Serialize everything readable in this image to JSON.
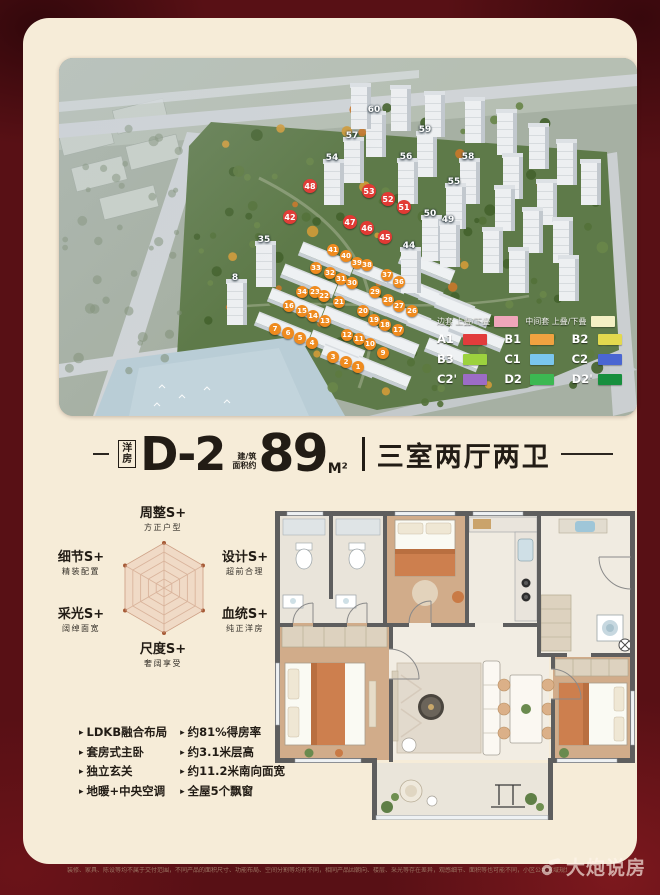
{
  "frame": {
    "maroon": "#581015",
    "cream": "#f6ecd8"
  },
  "aerial": {
    "legend": {
      "header": [
        {
          "label": "边套",
          "sub": "上叠/下叠",
          "color": "#f0a6ba"
        },
        {
          "label": "中间套",
          "sub": "上叠/下叠",
          "color": "#f4f0c4"
        }
      ],
      "rows": [
        [
          {
            "code": "A1",
            "color": "#e23c3c"
          },
          {
            "code": "B1",
            "color": "#f0a240"
          },
          {
            "code": "B2",
            "color": "#e3d94e"
          }
        ],
        [
          {
            "code": "B3",
            "color": "#9cd23e"
          },
          {
            "code": "C1",
            "color": "#7ac6ee"
          },
          {
            "code": "C2",
            "color": "#4a66d2"
          }
        ],
        [
          {
            "code": "C2'",
            "color": "#9c6cc6"
          },
          {
            "code": "D2",
            "color": "#3cb852"
          },
          {
            "code": "D2'",
            "color": "#178f3e"
          }
        ]
      ]
    },
    "marker_colors": {
      "red": "#e13a34",
      "orange": "#ef8b1f",
      "tower_text": "#ffffff"
    },
    "tower_labels": [
      {
        "n": "60",
        "x": 315,
        "y": 52
      },
      {
        "n": "57",
        "x": 293,
        "y": 78
      },
      {
        "n": "59",
        "x": 366,
        "y": 72
      },
      {
        "n": "54",
        "x": 273,
        "y": 100
      },
      {
        "n": "56",
        "x": 347,
        "y": 99
      },
      {
        "n": "58",
        "x": 409,
        "y": 99
      },
      {
        "n": "55",
        "x": 395,
        "y": 124
      },
      {
        "n": "35",
        "x": 205,
        "y": 182
      },
      {
        "n": "8",
        "x": 176,
        "y": 220
      },
      {
        "n": "50",
        "x": 371,
        "y": 156
      },
      {
        "n": "49",
        "x": 389,
        "y": 162
      },
      {
        "n": "44",
        "x": 350,
        "y": 188
      }
    ],
    "red_markers": [
      {
        "n": "48",
        "x": 251,
        "y": 128
      },
      {
        "n": "53",
        "x": 310,
        "y": 133
      },
      {
        "n": "52",
        "x": 329,
        "y": 141
      },
      {
        "n": "51",
        "x": 345,
        "y": 149
      },
      {
        "n": "47",
        "x": 291,
        "y": 164
      },
      {
        "n": "46",
        "x": 308,
        "y": 170
      },
      {
        "n": "45",
        "x": 326,
        "y": 179
      },
      {
        "n": "42",
        "x": 231,
        "y": 159
      }
    ],
    "orange_markers": [
      {
        "n": "41",
        "x": 274,
        "y": 192
      },
      {
        "n": "40",
        "x": 287,
        "y": 198
      },
      {
        "n": "39",
        "x": 298,
        "y": 205
      },
      {
        "n": "38",
        "x": 308,
        "y": 207
      },
      {
        "n": "37",
        "x": 328,
        "y": 217
      },
      {
        "n": "36",
        "x": 340,
        "y": 224
      },
      {
        "n": "33",
        "x": 257,
        "y": 210
      },
      {
        "n": "32",
        "x": 271,
        "y": 215
      },
      {
        "n": "31",
        "x": 282,
        "y": 221
      },
      {
        "n": "30",
        "x": 293,
        "y": 225
      },
      {
        "n": "29",
        "x": 316,
        "y": 234
      },
      {
        "n": "28",
        "x": 329,
        "y": 242
      },
      {
        "n": "27",
        "x": 340,
        "y": 248
      },
      {
        "n": "26",
        "x": 353,
        "y": 253
      },
      {
        "n": "34",
        "x": 243,
        "y": 234
      },
      {
        "n": "23",
        "x": 256,
        "y": 234
      },
      {
        "n": "22",
        "x": 265,
        "y": 238
      },
      {
        "n": "21",
        "x": 280,
        "y": 244
      },
      {
        "n": "20",
        "x": 304,
        "y": 253
      },
      {
        "n": "19",
        "x": 315,
        "y": 262
      },
      {
        "n": "18",
        "x": 326,
        "y": 267
      },
      {
        "n": "17",
        "x": 339,
        "y": 272
      },
      {
        "n": "16",
        "x": 230,
        "y": 248
      },
      {
        "n": "15",
        "x": 243,
        "y": 253
      },
      {
        "n": "14",
        "x": 254,
        "y": 258
      },
      {
        "n": "13",
        "x": 266,
        "y": 263
      },
      {
        "n": "12",
        "x": 288,
        "y": 277
      },
      {
        "n": "11",
        "x": 300,
        "y": 281
      },
      {
        "n": "10",
        "x": 311,
        "y": 286
      },
      {
        "n": "9",
        "x": 324,
        "y": 295
      },
      {
        "n": "7",
        "x": 216,
        "y": 271
      },
      {
        "n": "6",
        "x": 229,
        "y": 275
      },
      {
        "n": "5",
        "x": 241,
        "y": 280
      },
      {
        "n": "4",
        "x": 253,
        "y": 285
      },
      {
        "n": "3",
        "x": 274,
        "y": 299
      },
      {
        "n": "2",
        "x": 287,
        "y": 304
      },
      {
        "n": "1",
        "x": 299,
        "y": 309
      }
    ]
  },
  "title": {
    "tag_top": "洋",
    "tag_bottom": "房",
    "model": "D-2",
    "area_prefix": [
      "建/筑",
      "面积约"
    ],
    "area_value": "89",
    "area_unit": "M²",
    "layout": "三室两厅两卫"
  },
  "radar": {
    "max": 5,
    "rings": 5,
    "values": [
      5,
      5,
      5,
      5,
      5,
      5
    ],
    "axes": [
      {
        "label": "周整S+",
        "sub": "方正户型"
      },
      {
        "label": "设计S+",
        "sub": "超前合理"
      },
      {
        "label": "血统S+",
        "sub": "纯正洋房"
      },
      {
        "label": "尺度S+",
        "sub": "奢阔享受"
      },
      {
        "label": "采光S+",
        "sub": "阔绰面宽"
      },
      {
        "label": "细节S+",
        "sub": "精装配置"
      }
    ],
    "colors": {
      "grid": "#cfa489",
      "fill": "#eed3c0",
      "dot": "#a65a36"
    }
  },
  "features": {
    "col1": [
      "LDKB融合布局",
      "套房式主卧",
      "独立玄关",
      "地暖+中央空调"
    ],
    "col2": [
      "约81%得房率",
      "约3.1米层高",
      "约11.2米南向面宽",
      "全屋5个飘窗"
    ]
  },
  "disclaimer": "装修、家具、陈设等均不属于交付范围，不同产品的面积尺寸、功能布局、空间分割等均有不同，相同产品因朝向、楼层、采光等存在差异，观感细节、面积等也可能不同，小区公共区域规划范围不属于小区内绿地、花园、儿童活动区等相关区域，具体以政府批文及商品房买卖合同约定为准。",
  "watermark": {
    "text": "大炮说房"
  }
}
